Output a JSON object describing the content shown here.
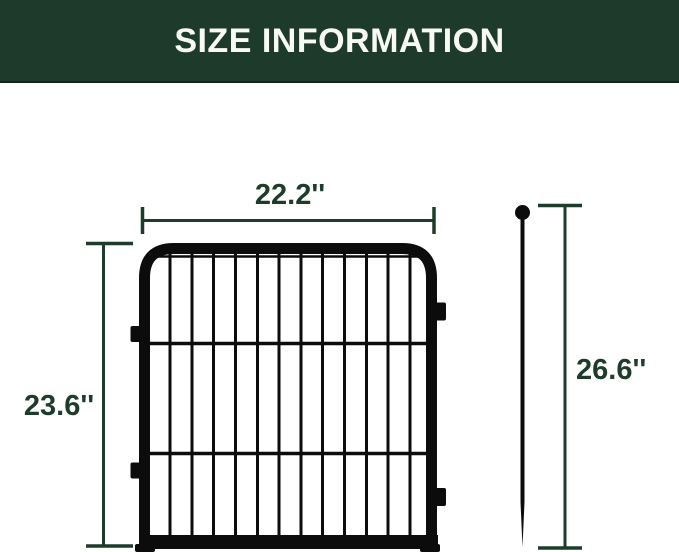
{
  "banner": {
    "title": "SIZE INFORMATION"
  },
  "diagram": {
    "panel": {
      "name": "fence panel",
      "width_label": "22.2''",
      "height_label": "23.6''"
    },
    "stake": {
      "name": "ground stake",
      "height_label": "26.6''"
    }
  },
  "theme": {
    "banner-bg": "#1e3a2a",
    "banner-border": "#14241a",
    "banner-text": "#f9f9f4",
    "accent": "#1d3c2b",
    "fence": "#0c0c0c",
    "page-bg": "#ffffff"
  }
}
